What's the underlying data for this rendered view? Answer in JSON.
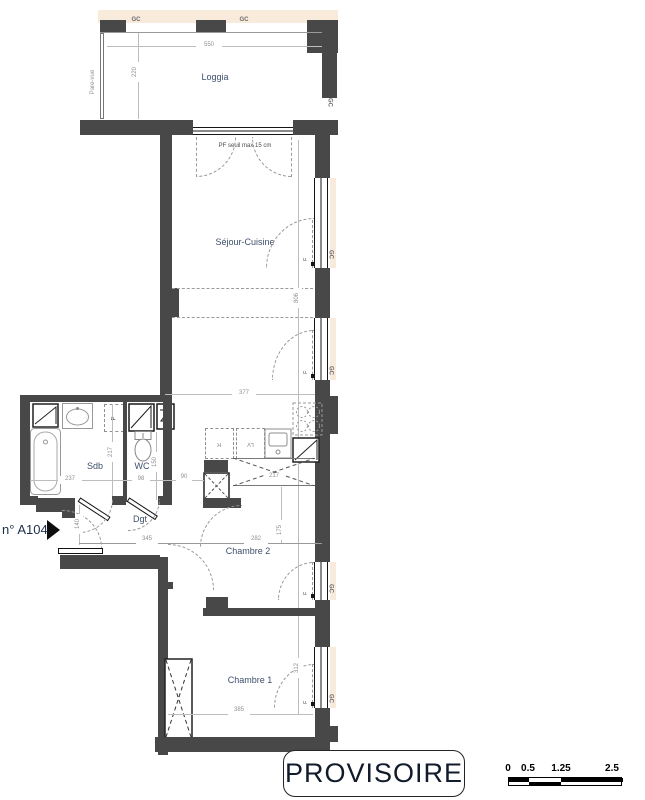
{
  "rooms": {
    "loggia": "Loggia",
    "sejour": "Séjour-Cuisine",
    "sdb": "Sdb",
    "wc": "WC",
    "dgt": "Dgt",
    "chambre2": "Chambre 2",
    "chambre1": "Chambre 1"
  },
  "annotations": {
    "gc": "GC",
    "pare_vue": "Pare-vue",
    "pf_note": "PF  seuil max 15 cm",
    "duct": "F",
    "fridge": "R",
    "dishwasher": "LV",
    "unit_number": "n° A104",
    "radiator_mark": "u."
  },
  "dims": {
    "loggia_width": "550",
    "loggia_depth": "220",
    "sejour_length": "806",
    "sejour_width": "377",
    "counter_width": "217",
    "sdb_width": "237",
    "sdb_depth": "217",
    "wc_width": "98",
    "wc_depth": "150",
    "passage_width": "90",
    "entry_width": "140",
    "dgt_length": "345",
    "chambre2_width": "282",
    "chambre2_depth": "175",
    "chambre1_width": "385",
    "chambre1_depth": "312"
  },
  "stamp": "PROVISOIRE",
  "scale_bar": {
    "ticks": [
      "0",
      "0.5",
      "1.25",
      "2.5"
    ]
  },
  "colors": {
    "wall": "#484848",
    "facade": "#f8ebdc",
    "room_label": "#3d4f6b",
    "dimension": "#8f8f8f"
  }
}
